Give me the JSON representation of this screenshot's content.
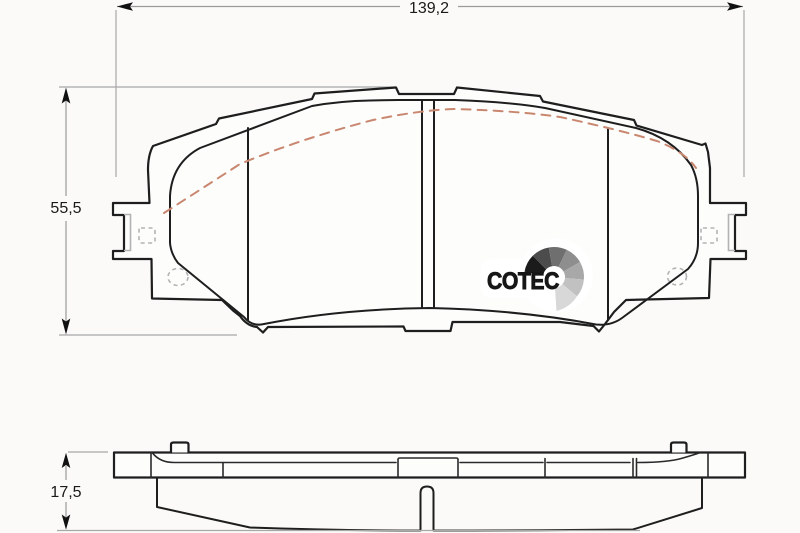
{
  "dimensions": {
    "width": {
      "label": "139,2"
    },
    "height": {
      "label": "55,5"
    },
    "thickness": {
      "label": "17,5"
    }
  },
  "logo": {
    "text": "COTEC",
    "fan_colors": [
      "#1b1b1b",
      "#4c4c4c",
      "#6f6f6f",
      "#8e8e8e",
      "#a8a8a8",
      "#c1c1c1",
      "#d8d8d8"
    ]
  },
  "colors": {
    "background": "#fbfaf8",
    "pad_friction": "#f5bfa7",
    "backplate": "#fdfdfc",
    "outline": "#1e1e1e",
    "dimension_lines": "#9a9a9a",
    "hidden_lines": "#b3b3b3",
    "chamfer_dashed": "#c9876f",
    "dimension_text": "#1a1a1a"
  }
}
